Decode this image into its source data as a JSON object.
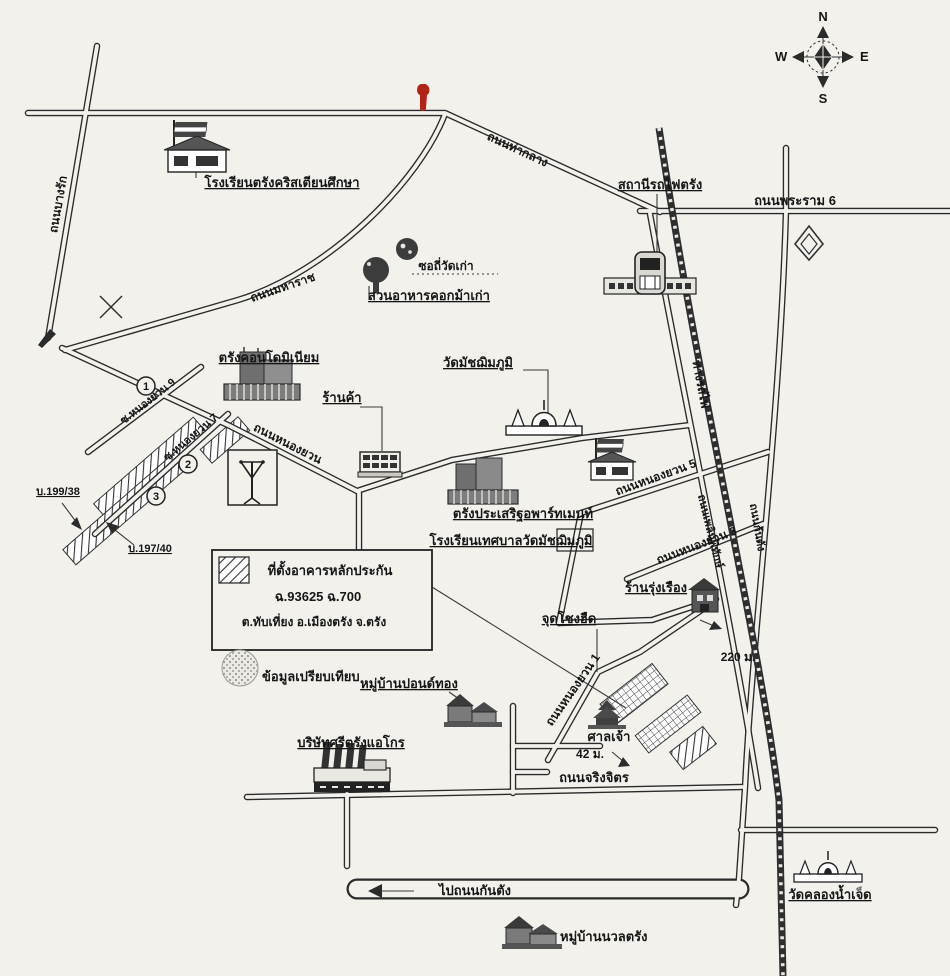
{
  "compass": {
    "n": "N",
    "w": "W",
    "e": "E",
    "s": "S"
  },
  "roads": {
    "bang_rak": "ถนนบางรัก",
    "maharat": "ถนนมหาราช",
    "tha_klang": "ถนนท่ากลาง",
    "rama6": "ถนนพระราม 6",
    "nong_yuan": "ถนนหนองยวน",
    "soi_nong_yuan9": "ซ.หนองยวน 9",
    "soi_nong_yuan7": "ซ.หนองยวน 7",
    "nong_yuan5": "ถนนหนองยวน 5",
    "nong_yuan3": "ถนนหนองยวน 3",
    "nong_yuan1": "ถนนหนองยวน 1",
    "railway": "ทางรถไฟ",
    "phloen_phithak": "ถนนเพลินพิทักษ์",
    "kantang": "ถนนกันตัง",
    "jingjit": "ถนนจริงจิตร",
    "to_kantang": "ไปถนนกันตัง"
  },
  "places": {
    "christian_school": "โรงเรียนตรังคริสเตียนศึกษา",
    "train_station": "สถานีรถไฟตรัง",
    "old_temple_soi": "ซอถี่วัดเก่า",
    "restaurant": "สวนอาหารคอกม้าเก่า",
    "condo": "ตรังคอนโดมิเนียม",
    "shop": "ร้านค้า",
    "wat_matchim": "วัดมัชฌิมภูมิ",
    "apartment": "ตรังประเสริฐอพาร์ทเมนท์",
    "municipal_school": "โรงเรียนเทศบาลวัดมัชฌิมภูมิ",
    "b199": "บ.199/38",
    "b197": "บ.197/40",
    "rung_rueang": "ร้านรุ่งเรือง",
    "chong_hued": "จุดโชงฮืด",
    "shrine": "ศาลเจ้า",
    "pond_thong": "หมู่บ้านปอนด์ทอง",
    "sri_trang": "บริษัทศรีตรังแอโกร",
    "nuan_trang": "หมู่บ้านนวลตรัง",
    "wat_khlong": "วัดคลองน้ำเจ็ด",
    "compare": "ข้อมูลเปรียบเทียบ"
  },
  "legend": {
    "line1": "ที่ตั้งอาคารหลักประกัน",
    "line2": "ฉ.93625 ฉ.700",
    "line3": "ต.ทับเที่ยง อ.เมืองตรัง จ.ตรัง"
  },
  "distances": {
    "d220": "220 ม.",
    "d42": "42 ม."
  },
  "plot_markers": [
    "1",
    "2",
    "3"
  ],
  "colors": {
    "marker_red": "#b22318",
    "ink": "#2b2b2b",
    "paper": "#f2f1ec"
  }
}
